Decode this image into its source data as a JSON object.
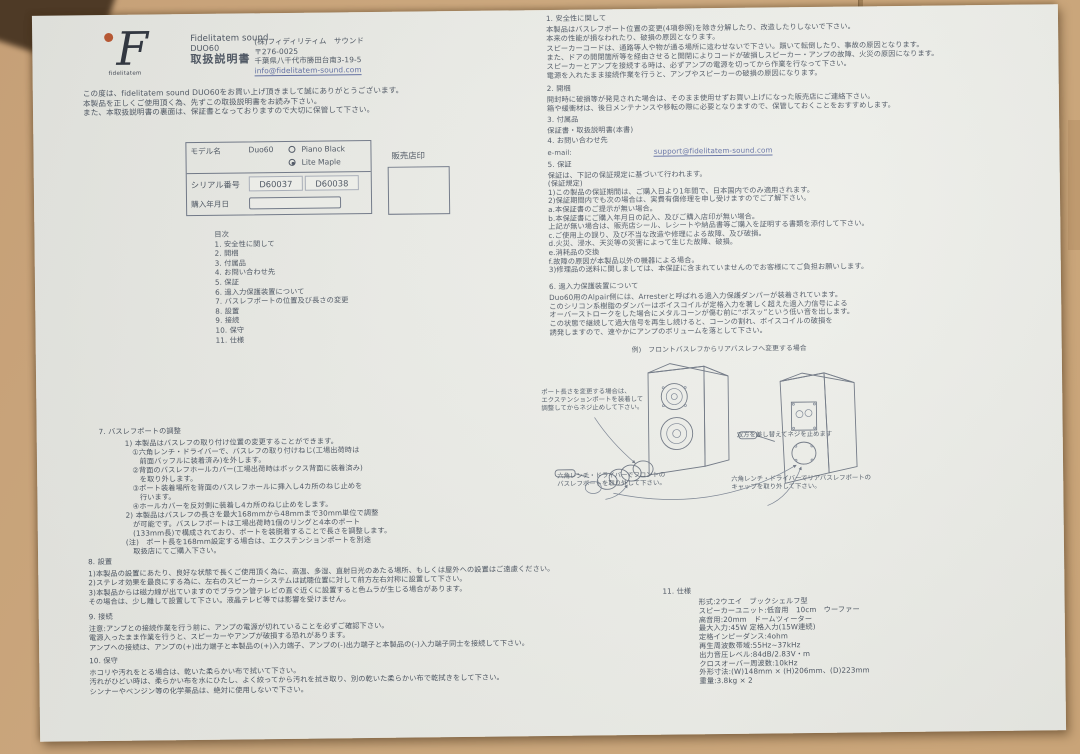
{
  "header": {
    "logo_letter": "F",
    "logo_caption": "fidelitatem",
    "brand": "Fidelitatem sound",
    "model": "DUO60",
    "doc_title": "取扱説明書",
    "company_lines": [
      "(株)フィディリティム　サウンド",
      "〒276-0025",
      "千葉県八千代市勝田台南3-19-5"
    ],
    "company_email": "info@fidelitatem-sound.com"
  },
  "intro_lines": [
    "この度は、fidelitatem sound DUO60をお買い上げ頂きまして誠にありがとうございます。",
    "本製品を正しくご使用頂く為、先ずこの取扱説明書をお読み下さい。",
    "また、本取扱説明書の裏面は、保証書となっておりますので大切に保管して下さい。"
  ],
  "model_table": {
    "model_label": "モデル名",
    "model_value": "Duo60",
    "color_options": [
      "Piano Black",
      "Lite Maple"
    ],
    "serial_label": "シリアル番号",
    "serial_values": [
      "D60037",
      "D60038"
    ],
    "purchase_label": "購入年月日",
    "dealer_stamp_label": "販売店印"
  },
  "toc": {
    "title": "目次",
    "items": [
      "1. 安全性に関して",
      "2. 開梱",
      "3. 付属品",
      "4. お問い合わせ先",
      "5. 保証",
      "6. 過入力保護装置について",
      "7. バスレフポートの位置及び長さの変更",
      "8. 設置",
      "9. 接続",
      "10. 保守",
      "11. 仕様"
    ]
  },
  "section7": {
    "title": "7. バスレフポートの調整",
    "lines": [
      "1) 本製品はバスレフの取り付け位置の変更することができます。",
      "　①六角レンチ・ドライバーで、バスレフの取り付けねじ(工場出荷時は",
      "　　前面バッフルに装着済み)を外します。",
      "　②背面のバスレフホールカバー(工場出荷時はボックス背面に装着済み)",
      "　　を取り外します。",
      "　③ポート装着場所を背面のバスレフホールに挿入し4カ所のねじ止めを",
      "　　行います。",
      "　④ホールカバーを反対側に装着し4カ所のねじ止めをします。",
      "2) 本製品はバスレフの長さを最大168mmから48mmまで30mm単位で調整",
      "　が可能です。バスレフポートは工場出荷時1個のリングと4本のポート",
      "　(133mm長)で構成されており、ポートを装脱着することで長さを調整します。",
      "(注)　ポート長を168mm設定する場合は、エクステンションポートを別途",
      "　取扱店にてご購入下さい。"
    ]
  },
  "section8": {
    "title": "8. 設置",
    "lines": [
      "1)本製品の設置にあたり、良好な状態で長くご使用頂く為に、高温、多湿、直射日光のあたる場所、もしくは屋外への設置はご遠慮ください。",
      "2)ステレオ効果を最良にする為に、左右のスピーカーシステムは試聴位置に対して前方左右対称に設置して下さい。",
      "3)本製品からは磁力線が出ていますのでブラウン管テレビの直ぐ近くに設置すると色ムラが生じる場合があります。",
      "その場合は、少し離して設置して下さい。液晶テレビ等では影響を受けません。"
    ]
  },
  "section9": {
    "title": "9. 接続",
    "lines": [
      "注意:アンプとの接続作業を行う前に、アンプの電源が切れていることを必ずご確認下さい。",
      "電源入ったまま作業を行うと、スピーカーやアンプが破損する恐れがあります。",
      "アンプへの接続は、アンプの(+)出力端子と本製品の(+)入力端子、アンプの(-)出力端子と本製品の(-)入力端子同士を接続して下さい。"
    ]
  },
  "section10": {
    "title": "10. 保守",
    "lines": [
      "ホコリや汚れをとる場合は、乾いた柔らかい布で拭いて下さい。",
      "汚れがひどい時は、柔らかい布を水にひたし、よく絞ってから汚れを拭き取り、別の乾いた柔らかい布で乾拭きをして下さい。",
      "シンナーやベンジン等の化学薬品は、絶対に使用しないで下さい。"
    ]
  },
  "section1": {
    "title": "1. 安全性に関して",
    "lines": [
      "本製品はバスレフポート位置の変更(4項参照)を除き分解したり、改造したりしないで下さい。",
      "本来の性能が損なわれたり、破損の原因となります。",
      "スピーカーコードは、通路等人や物が通る場所に這わせないで下さい。躓いて転倒したり、事故の原因となります。",
      "また、ドアの開閉箇所等を経由させると開閉によりコードが破損しスピーカー・アンプの故障、火災の原因になります。",
      "スピーカーとアンプを接続する時は、必ずアンプの電源を切ってから作業を行なって下さい。",
      "電源を入れたまま接続作業を行うと、アンプやスピーカーの破損の原因になります。"
    ]
  },
  "section2": {
    "title": "2. 開梱",
    "lines": [
      "開封時に破損等が発見された場合は、そのまま使用せずお買い上げになった販売店にご連絡下さい。",
      "箱や緩衝材は、後日メンテナンスや移転の際に必要となりますので、保管しておくことをおすすめします。"
    ]
  },
  "section3": {
    "title": "3. 付属品",
    "lines": [
      "保証書・取扱説明書(本書)"
    ]
  },
  "section4": {
    "title": "4. お問い合わせ先",
    "email_label": "e-mail:",
    "email": "support@fidelitatem-sound.com"
  },
  "section5": {
    "title": "5. 保証",
    "lines": [
      "保証は、下記の保証規定に基づいて行われます。",
      "(保証規定)",
      "1)この製品の保証期間は、ご購入日より1年間で、日本国内でのみ適用されます。",
      "2)保証期間内でも次の場合は、実費有償修理を申し受けますのでご了解下さい。",
      "a.本保証書のご提示が無い場合。",
      "b.本保証書にご購入年月日の記入、及びご購入店印が無い場合。",
      "上記が無い場合は、販売店シール、レシートや納品書等ご購入を証明する書類を添付して下さい。",
      "c.ご使用上の誤り、及び不当な改造や修理による故障、及び破損。",
      "d.火災、浸水、天災等の災害によって生じた故障、破損。",
      "e.消耗品の交換",
      "f.故障の原因が本製品以外の機器による場合。",
      "3)修理品の送料に関しましては、本保証に含まれていませんのでお客様にてご負担お願いします。"
    ]
  },
  "section6": {
    "title": "6. 過入力保護装置について",
    "lines": [
      "Duo60用のAlpair側には、Arresterと呼ばれる過入力保護ダンパーが装着されています。",
      "このシリコン系樹脂のダンパーはボイスコイルが定格入力を著しく超えた過入力信号による",
      "オーバーストロークをした場合にメタルコーンが傷む前に“ポスッ”という低い音を出します。",
      "この状態で継続して過大信号を再生し続けると、コーンの割れ、ボイスコイルの破損を",
      "誘発しますので、速やかにアンプのボリュームを落として下さい。"
    ]
  },
  "diagram": {
    "caption": "例)　フロントバスレフからリアバスレフへ変更する場合",
    "label_extension": [
      "ポート長さを変更する場合は、",
      "エクステンションポートを装着して",
      "調整してからネジ止めして下さい。"
    ],
    "label_front": [
      "六角レンチ・ドライバーでフロントの",
      "バスレフポートを取り外して下さい。"
    ],
    "label_swap": "双方を差し替えてネジを止めます",
    "label_rear": [
      "六角レンチ・ドライバーでリアバスレフポートの",
      "キャップを取り外して下さい。"
    ]
  },
  "section11": {
    "title": "11. 仕様",
    "lines": [
      "形式:2ウエイ　ブックシェルフ型",
      "スピーカーユニット:低音用　10cm　ウーファー",
      "高音用:20mm　ドームツィーター",
      "最大入力:45W 定格入力(15W連続)",
      "定格インピーダンス:4ohm",
      "再生周波数帯域:55Hz~37kHz",
      "出力音圧レベル:84dB/2.83V・m",
      "クロスオーバー周波数:10kHz",
      "外形寸法:(W)148mm × (H)206mm、(D)223mm",
      "重量:3.8kg × 2"
    ]
  }
}
